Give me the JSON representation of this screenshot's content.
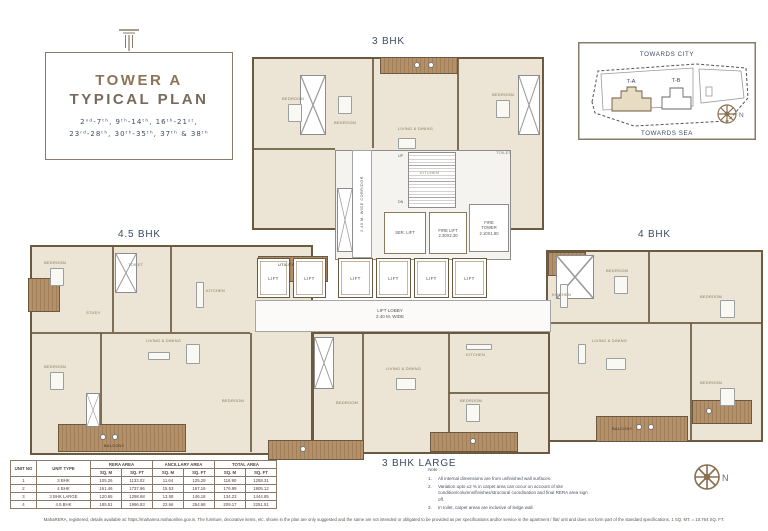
{
  "title_block": {
    "line1": "TOWER A",
    "line2": "TYPICAL PLAN",
    "floors_line1": "2ⁿᵈ-7ᵗʰ,  9ᵗʰ-14ᵗʰ,  16ᵗʰ-21ˢᵗ,",
    "floors_line2": "23ʳᵈ-28ᵗʰ,  30ᵗʰ-35ᵗʰ,  37ᵗʰ & 38ᵗʰ"
  },
  "site_map": {
    "towards_city": "TOWARDS CITY",
    "towards_sea": "TOWARDS SEA",
    "tower_a": "T-A",
    "tower_b": "T-B",
    "north": "N"
  },
  "unit_labels": {
    "top": "3 BHK",
    "left": "4.5 BHK",
    "right": "4 BHK",
    "bottom": "3 BHK LARGE"
  },
  "core": {
    "lift": "LIFT",
    "ser_lift": "SER. LIFT",
    "fire_lift": "FIRE LIFT",
    "fire_lift_size": "2.30X2.30",
    "fire_tower_1": "FIRE",
    "fire_tower_2": "TOWER",
    "fire_tower_size": "2.10X1.80",
    "lift_lobby_1": "LIFT LOBBY",
    "lift_lobby_2": "2.40 M. WIDE",
    "corridor": "2.40 M. WIDE CORRIDOR",
    "up": "UP",
    "dn": "DN"
  },
  "room_labels": {
    "bedroom": "BEDROOM",
    "living_dining": "LIVING & DINING",
    "kitchen": "KITCHEN",
    "study": "STUDY",
    "toilet": "TOILET",
    "balcony": "BALCONY",
    "utility": "UTILITY"
  },
  "area_table": {
    "headers": {
      "unit_no": "UNIT NO",
      "unit_type": "UNIT TYPE",
      "rera": "RERA AREA",
      "ancillary": "ANCILLARY AREA",
      "total": "TOTAL AREA",
      "sqm": "SQ. M",
      "sqft": "SQ. FT"
    },
    "rows": [
      {
        "no": "1",
        "type": "3 BHK",
        "rera_sqm": "105.26",
        "rera_sqft": "1133.02",
        "anc_sqm": "11.64",
        "anc_sqft": "125.29",
        "tot_sqm": "116.90",
        "tot_sqft": "1258.31"
      },
      {
        "no": "2",
        "type": "4 BHK",
        "rera_sqm": "161.46",
        "rera_sqft": "1737.96",
        "anc_sqm": "15.53",
        "anc_sqft": "167.16",
        "tot_sqm": "176.99",
        "tot_sqft": "1905.12"
      },
      {
        "no": "3",
        "type": "3 BHK LARGE",
        "rera_sqm": "120.65",
        "rera_sqft": "1298.68",
        "anc_sqm": "13.58",
        "anc_sqft": "146.18",
        "tot_sqm": "134.23",
        "tot_sqft": "1444.85"
      },
      {
        "no": "4",
        "type": "4.5 BHK",
        "rera_sqm": "185.51",
        "rera_sqft": "1996.83",
        "anc_sqm": "23.66",
        "anc_sqft": "254.68",
        "tot_sqm": "209.17",
        "tot_sqft": "2251.51"
      }
    ]
  },
  "notes": {
    "heading": "Note :-",
    "items": [
      {
        "num": "1.",
        "text": "All internal dimensions are from unfinished wall surfaces."
      },
      {
        "num": "2.",
        "text": "Variation upto ±2 % in carpet area can occur on account of site condition/columns/finishes/structural coordination and final RERA area sign off."
      },
      {
        "num": "3.",
        "text": "In toilet, carpet areas are inclusive of ledge wall."
      }
    ]
  },
  "disclaimer": "MahaRERA, registered, details available at: https://maharera.mahaonline.gov.in. The furniture, decorative items, etc. shown in the plan are only suggested and the same are not intended or obligated to be provided as per specifications and/or service in the apartment / flat/ unit and does not form part of the standard specifications. 1 SQ. MT. = 10.764 SQ. FT.",
  "colors": {
    "wall": "#6b5940",
    "room_fill": "#ece4d4",
    "wood": "#a98a5f",
    "navy": "#3d4b63",
    "accent_brown": "#8b7a68"
  }
}
